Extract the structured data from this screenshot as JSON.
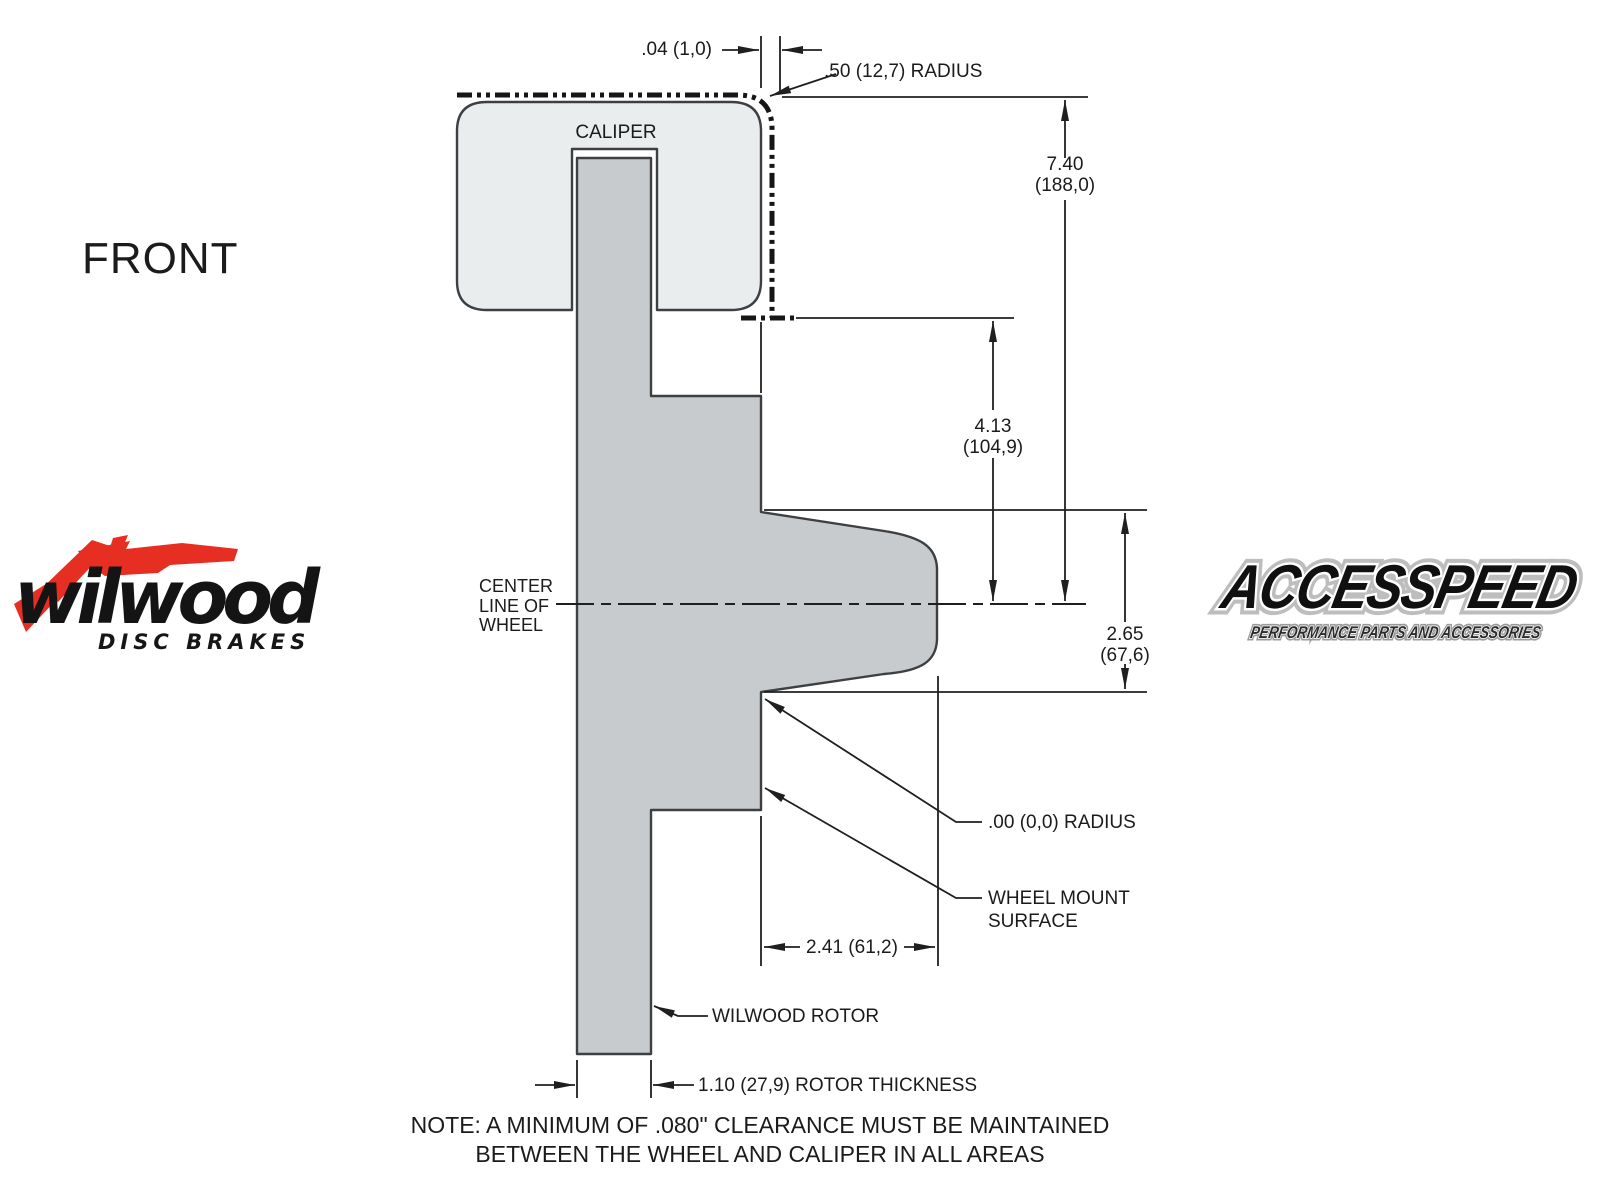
{
  "page": {
    "view_label": "FRONT"
  },
  "drawing": {
    "caliper_label": "CALIPER",
    "centerline_label": {
      "l1": "CENTER",
      "l2": "LINE OF",
      "l3": "WHEEL"
    },
    "dims": {
      "clearance_gap": ".04 (1,0)",
      "outer_radius": ".50 (12,7) RADIUS",
      "caliper_height": {
        "in": "7.40",
        "mm": "(188,0)"
      },
      "caliper_lower_height": {
        "in": "4.13",
        "mm": "(104,9)"
      },
      "mount_offset": {
        "in": "2.65",
        "mm": "(67,6)"
      },
      "zero_radius": ".00 (0,0) RADIUS",
      "wheel_mount_surface": {
        "l1": "WHEEL MOUNT",
        "l2": "SURFACE"
      },
      "hat_depth": "2.41 (61,2)",
      "rotor_callout": "WILWOOD ROTOR",
      "rotor_thickness": "1.10 (27,9) ROTOR THICKNESS"
    },
    "note": {
      "line1": "NOTE: A MINIMUM OF .080\" CLEARANCE MUST BE MAINTAINED",
      "line2": "BETWEEN THE WHEEL AND CALIPER IN ALL AREAS"
    }
  },
  "logos": {
    "wilwood": {
      "wordmark": "wilwood",
      "tagline": "DISC BRAKES"
    },
    "accesspeed": {
      "wordmark": "ACCESSPEED",
      "tagline": "PERFORMANCE PARTS AND ACCESSORIES"
    }
  },
  "colors": {
    "background": "#ffffff",
    "caliper_fill": "#e9edee",
    "rotor_fill": "#c7cbce",
    "line_color": "#1f1f1f",
    "wilwood_red": "#e62e22",
    "logo_black": "#121212"
  }
}
